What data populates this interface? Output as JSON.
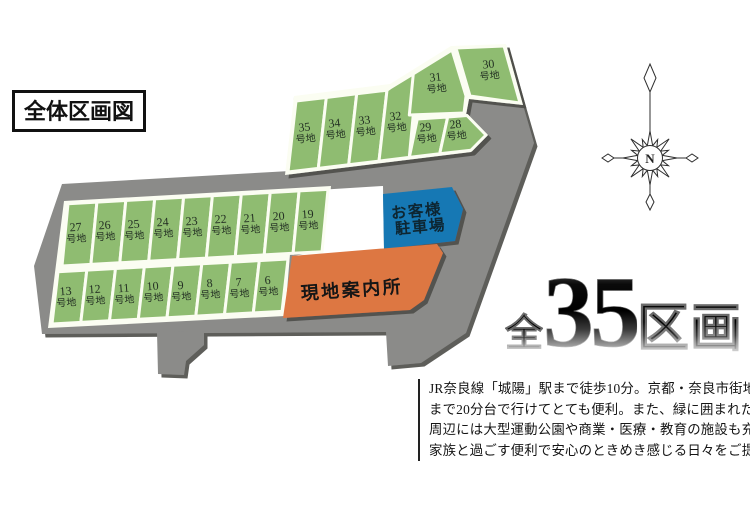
{
  "title": "全体区画図",
  "map": {
    "lot_suffix": "号地",
    "top_row": [
      "35",
      "34",
      "33",
      "32",
      "29",
      "28"
    ],
    "upper_lots": [
      "31",
      "30"
    ],
    "middle_row": [
      "27",
      "26",
      "25",
      "24",
      "23",
      "22",
      "21",
      "20",
      "19"
    ],
    "bottom_row": [
      "13",
      "12",
      "11",
      "10",
      "9",
      "8",
      "7",
      "6"
    ],
    "parking": {
      "line1": "お客様",
      "line2": "駐車場"
    },
    "office_label": "現地案内所",
    "colors": {
      "lot_green": "#8fbc71",
      "road_gray": "#8b8b89",
      "parking_blue": "#1878b4",
      "office_orange": "#dd7743",
      "seam_white": "#fbfdf2",
      "bevel_dark": "#4e4e48"
    }
  },
  "compass": {
    "label": "N"
  },
  "headline": {
    "prefix": "全",
    "number": "35",
    "suffix": "区画"
  },
  "description": {
    "lines": [
      "JR奈良線「城陽」駅まで徒歩10分。京都・奈良市街地",
      "まで20分台で行けてとても便利。また、緑に囲まれた",
      "周辺には大型運動公園や商業・医療・教育の施設も充実。",
      "家族と過ごす便利で安心のときめき感じる日々をご提案。"
    ]
  }
}
